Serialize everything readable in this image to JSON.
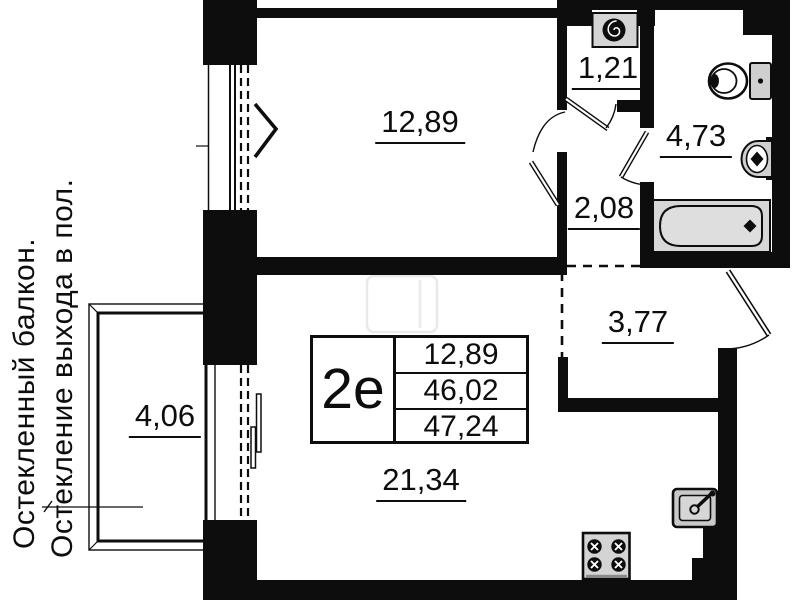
{
  "unit": {
    "type_label": "2е",
    "living_area": "12,89",
    "area_without_balcony": "46,02",
    "total_area": "47,24"
  },
  "rooms": {
    "bedroom": "12,89",
    "storage": "1,21",
    "bathroom": "4,73",
    "hallway": "2,08",
    "entry_hall": "3,77",
    "balcony": "4,06",
    "kitchen_living": "21,34"
  },
  "annotations": {
    "note_line_1": "Остекленный балкон.",
    "note_line_2": "Остекление выхода в пол."
  },
  "icons": {
    "washing_machine": "washing-machine-icon",
    "toilet": "toilet-icon",
    "wash_basin": "wash-basin-icon",
    "bathtub": "bathtub-icon",
    "kitchen_sink": "kitchen-sink-icon",
    "stove": "stove-icon"
  },
  "colors": {
    "wall": "#0d0d0d",
    "fixture_fill": "#d4d4d4",
    "background": "#ffffff"
  }
}
